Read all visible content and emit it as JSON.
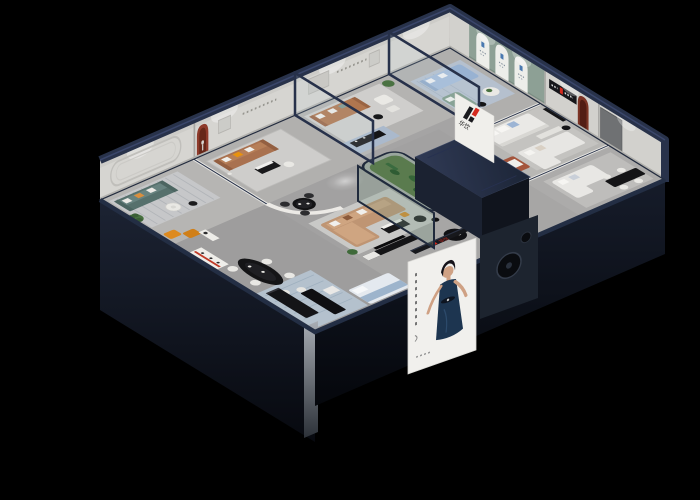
{
  "scene": {
    "subject": "Isometric 3D cutaway render of a furniture showroom",
    "background_color": "#000000",
    "brand": {
      "logo_mark": "H",
      "logo_text": "华饮",
      "logo_red": "#d42a1e",
      "logo_black": "#1a1a1e"
    },
    "poster": {
      "description": "Model in a dark blue dress on a white backdrop",
      "dress_color": "#1d3550"
    },
    "palette": {
      "interior_wall": "#d6d5d1",
      "wall_top_navy": "#28324a",
      "floor_grey": "#a5a4a4",
      "exterior_dark": "#0b0e16",
      "sage_feature_wall": "#8da095",
      "terracotta": "#a4553c",
      "maroon_arch": "#7c3526",
      "teal_sofa": "#56706c",
      "brown_leather": "#a9714f",
      "camel_sofa": "#bf9573",
      "powder_blue_sofa": "#a4bcda",
      "slate_sofa": "#7f99a8",
      "plant_green": "#47713f"
    },
    "rooms": [
      {
        "name": "teal-lounge",
        "contents": "teal sofa, striped rug, round table, plant, rounded wall moulding"
      },
      {
        "name": "brown-living",
        "contents": "brown leather sofa, black coffee table, red arched niche with sculpture"
      },
      {
        "name": "caramel-living",
        "contents": "caramel sofa, white armchair, black media console on blue rug"
      },
      {
        "name": "blue-lounge",
        "contents": "powder blue sofa, green chaise, sage wall with three white arches"
      },
      {
        "name": "white-bedroom",
        "contents": "white beds, terracotta high-back chair, brand logo partition"
      },
      {
        "name": "east-suite",
        "contents": "white chaise sofa, black dining table with white chairs, maroon arch, grey door"
      },
      {
        "name": "central-display",
        "contents": "camel corner sofa, round black table, TV bench, glass cactus terrarium, navy roofed room"
      },
      {
        "name": "front-gallery",
        "contents": "black benches, oval bar table, slate sofa with ottoman, mattress display, model poster, turntable panel"
      }
    ]
  }
}
